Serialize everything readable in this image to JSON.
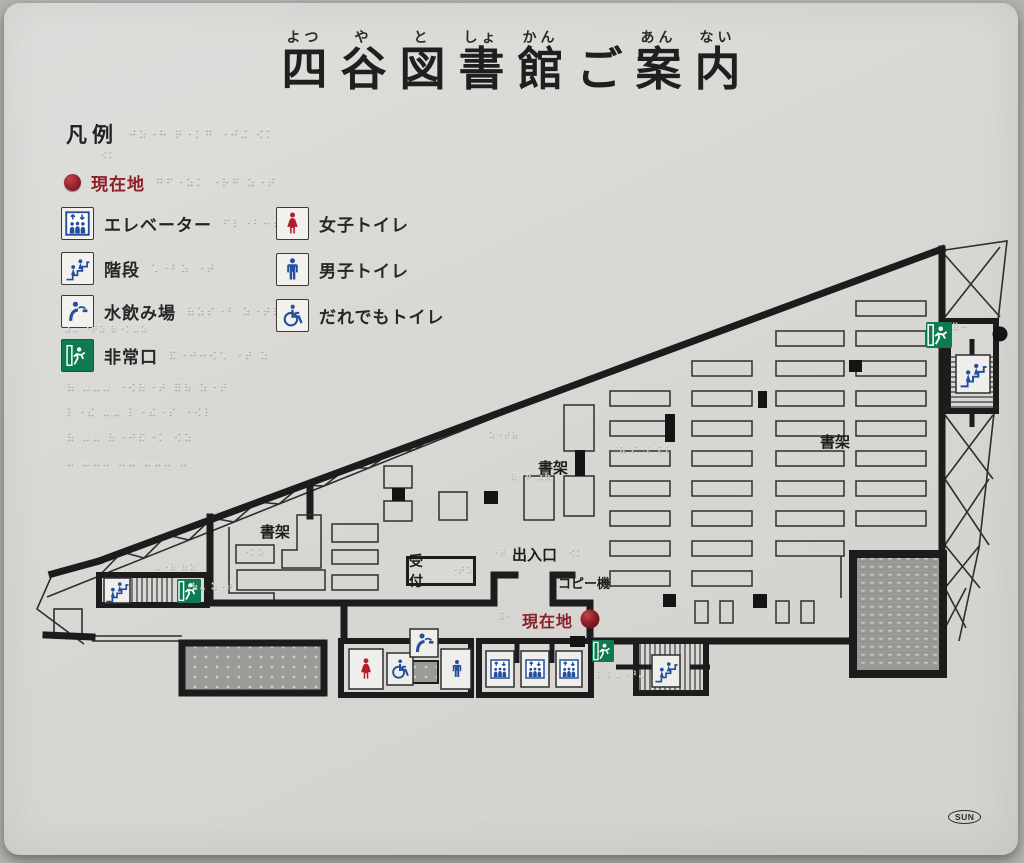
{
  "title": {
    "text": "四谷図書館ご案内",
    "chars": [
      {
        "b": "四",
        "r": "よつ"
      },
      {
        "b": "谷",
        "r": "や"
      },
      {
        "b": "図",
        "r": "と"
      },
      {
        "b": "書",
        "r": "しょ"
      },
      {
        "b": "館",
        "r": "かん"
      },
      {
        "b": "ご",
        "r": ""
      },
      {
        "b": "案",
        "r": "あん"
      },
      {
        "b": "内",
        "r": "ない"
      }
    ]
  },
  "legend": {
    "heading": "凡例",
    "heading_braille": "⠚⠵⠐⠓ ⠟⠐⠅⠛ ⠐⠚⠬ ⠪⠅",
    "heading_braille2": "⠪⠅",
    "current": {
      "label": "現在地",
      "braille": "⠛⠋⠐⠵⠅ ⠐⠗⠛ ⠵⠐⠞"
    },
    "items": [
      {
        "label": "エレベーター",
        "braille": "⠋⠇⠐⠃⠒⠞ ⠐⠵",
        "icon": "elevator-icon"
      },
      {
        "label": "階段",
        "braille": "⠡⠐⠃⠵  ⠐⠞",
        "icon": "stairs-icon"
      },
      {
        "label": "水飲み場",
        "braille": "⠷⠵⠎⠐⠃ ⠵⠐⠞⠷",
        "icon": "fountain-icon"
      },
      {
        "label": "非常口",
        "braille": "⠯⠐⠚⠒⠪⠡ ⠐⠞ ⠵",
        "icon": "emergency-exit-icon"
      }
    ],
    "fountain_braille2": "⠴⠤ ⠐⠞⠵ ⠷⠐⠅⠤⠵",
    "toilets": [
      {
        "label": "女子トイレ",
        "icon": "women-toilet-icon"
      },
      {
        "label": "男子トイレ",
        "icon": "men-toilet-icon"
      },
      {
        "label": "だれでもトイレ",
        "icon": "accessible-toilet-icon"
      }
    ],
    "paragraph": [
      "⠷ ⠤⠤⠤ ⠐⠪⠷⠐⠞ ⠿⠷ ⠵⠐⠞",
      "⠇⠐⠮ ⠤⠤ ⠇⠐⠮⠐⠎ ⠐⠪⠇",
      "⠷ ⠤⠤ ⠷⠐⠚⠯⠐⠅ ⠪⠵",
      "⠤ ⠤⠤⠤ ⠤⠤ ⠤⠤⠤ ⠤"
    ]
  },
  "map": {
    "labels": {
      "shelf_left": "書架",
      "shelf_center": "書架",
      "shelf_right": "書架",
      "reception": "受付",
      "entrance": "出入口",
      "copier": "コピー機",
      "current": "現在地"
    },
    "braille": {
      "entrance_left": "⠐⠞",
      "entrance_right": "⠪⠅",
      "current": "⠿⠂",
      "reception": "⠐⠞⠵",
      "center": "⠐⠚⠵ ⠞⠐⠇ ⠗⠕",
      "center2": "⠷⠐⠞ ⠵⠷",
      "upper": "⠵⠐⠞⠷",
      "bar1": "⠐⠅⠵",
      "left1": "⠤⠐⠷ ⠷⠵",
      "left2": "⠐⠷⠤ ⠵⠐⠞",
      "exit_bottom": "⠇⠸ ⠤⠐⠞⠤",
      "stairwell": "⠿⠒"
    }
  },
  "colors": {
    "accent_blue": "#234f9d",
    "exit_green": "#0d7a52",
    "women_red": "#b01e2e",
    "current_red": "#8d1f28",
    "line": "#1c1c1c",
    "tactile_gray": "#9b9995"
  },
  "footer": {
    "logo": "SUN"
  }
}
